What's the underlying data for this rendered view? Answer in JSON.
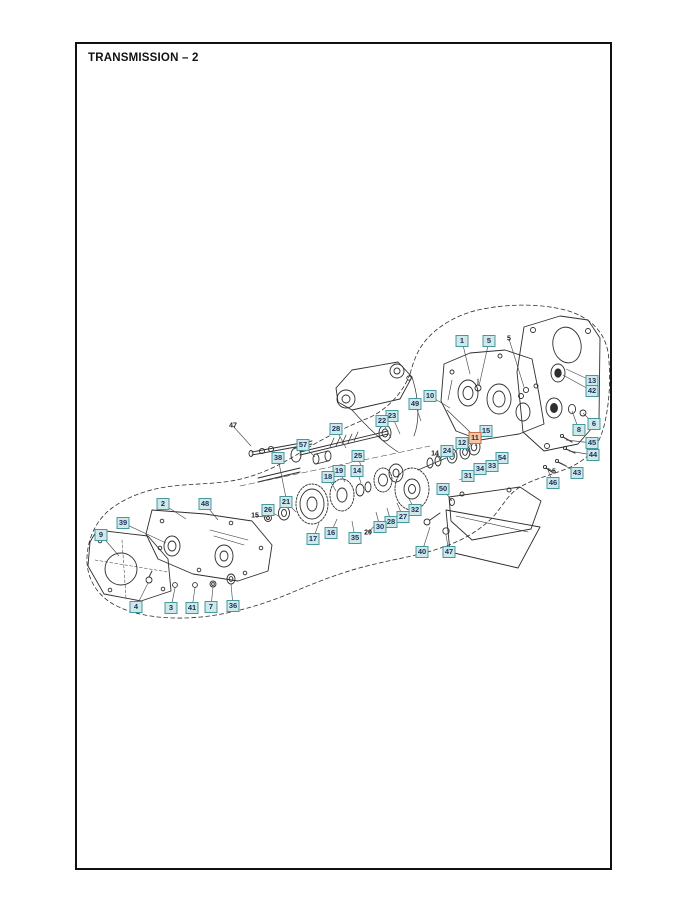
{
  "page": {
    "title": "TRANSMISSION – 2"
  },
  "diagram": {
    "colors": {
      "callout_bg": "#cfe9e9",
      "callout_border": "#44989e",
      "callout_text": "#1c2f5e",
      "highlight_bg": "#f6c6a2",
      "highlight_border": "#c96f4a",
      "leader_line": "#4d4d4d",
      "art_line": "#2e2e2e"
    },
    "callouts": [
      {
        "n": "1",
        "x": 462,
        "y": 341,
        "tx": 470,
        "ty": 374
      },
      {
        "n": "5",
        "x": 489,
        "y": 341,
        "tx": 479,
        "ty": 386
      },
      {
        "n": "13",
        "x": 592,
        "y": 381,
        "tx": 566,
        "ty": 369
      },
      {
        "n": "42",
        "x": 592,
        "y": 391,
        "tx": 563,
        "ty": 375
      },
      {
        "n": "10",
        "x": 430,
        "y": 396,
        "tx": 450,
        "ty": 408
      },
      {
        "n": "49",
        "x": 415,
        "y": 404,
        "tx": 421,
        "ty": 421
      },
      {
        "n": "23",
        "x": 392,
        "y": 416,
        "tx": 400,
        "ty": 434
      },
      {
        "n": "22",
        "x": 382,
        "y": 421,
        "tx": 391,
        "ty": 438
      },
      {
        "n": "6",
        "x": 594,
        "y": 424,
        "tx": 583,
        "ty": 413
      },
      {
        "n": "8",
        "x": 579,
        "y": 430,
        "tx": 572,
        "ty": 411
      },
      {
        "n": "15",
        "x": 486,
        "y": 431,
        "tx": 475,
        "ty": 446
      },
      {
        "n": "11",
        "x": 475,
        "y": 438,
        "tx": 466,
        "ty": 451,
        "hl": true
      },
      {
        "n": "12",
        "x": 462,
        "y": 443,
        "tx": 453,
        "ty": 455
      },
      {
        "n": "45",
        "x": 592,
        "y": 443,
        "tx": 566,
        "ty": 440
      },
      {
        "n": "28",
        "x": 336,
        "y": 429,
        "tx": 346,
        "ty": 448
      },
      {
        "n": "57",
        "x": 303,
        "y": 445,
        "tx": 315,
        "ty": 457
      },
      {
        "n": "24",
        "x": 447,
        "y": 451,
        "tx": 439,
        "ty": 460
      },
      {
        "n": "44",
        "x": 593,
        "y": 455,
        "tx": 569,
        "ty": 451
      },
      {
        "n": "25",
        "x": 358,
        "y": 456,
        "tx": 362,
        "ty": 470
      },
      {
        "n": "38",
        "x": 278,
        "y": 458,
        "tx": 288,
        "ty": 508
      },
      {
        "n": "54",
        "x": 502,
        "y": 458,
        "tx": 490,
        "ty": 465
      },
      {
        "n": "33",
        "x": 492,
        "y": 466,
        "tx": 481,
        "ty": 471
      },
      {
        "n": "34",
        "x": 480,
        "y": 469,
        "tx": 471,
        "ty": 475
      },
      {
        "n": "19",
        "x": 339,
        "y": 471,
        "tx": 345,
        "ty": 482
      },
      {
        "n": "14",
        "x": 357,
        "y": 471,
        "tx": 361,
        "ty": 483
      },
      {
        "n": "43",
        "x": 577,
        "y": 473,
        "tx": 561,
        "ty": 463
      },
      {
        "n": "31",
        "x": 468,
        "y": 476,
        "tx": 459,
        "ty": 480
      },
      {
        "n": "18",
        "x": 328,
        "y": 477,
        "tx": 336,
        "ty": 491
      },
      {
        "n": "46",
        "x": 553,
        "y": 483,
        "tx": 548,
        "ty": 470
      },
      {
        "n": "50",
        "x": 443,
        "y": 489,
        "tx": 452,
        "ty": 501
      },
      {
        "n": "21",
        "x": 286,
        "y": 502,
        "tx": 296,
        "ty": 512
      },
      {
        "n": "2",
        "x": 163,
        "y": 504,
        "tx": 186,
        "ty": 519
      },
      {
        "n": "48",
        "x": 205,
        "y": 504,
        "tx": 218,
        "ty": 520
      },
      {
        "n": "26",
        "x": 268,
        "y": 510,
        "tx": 280,
        "ty": 517
      },
      {
        "n": "32",
        "x": 415,
        "y": 510,
        "tx": 408,
        "ty": 497
      },
      {
        "n": "27",
        "x": 403,
        "y": 517,
        "tx": 397,
        "ty": 503
      },
      {
        "n": "28",
        "x": 391,
        "y": 522,
        "tx": 387,
        "ty": 508
      },
      {
        "n": "39",
        "x": 123,
        "y": 523,
        "tx": 166,
        "ty": 543
      },
      {
        "n": "30",
        "x": 380,
        "y": 527,
        "tx": 376,
        "ty": 512
      },
      {
        "n": "16",
        "x": 331,
        "y": 533,
        "tx": 337,
        "ty": 519
      },
      {
        "n": "9",
        "x": 101,
        "y": 535,
        "tx": 119,
        "ty": 556
      },
      {
        "n": "35",
        "x": 355,
        "y": 538,
        "tx": 352,
        "ty": 521
      },
      {
        "n": "17",
        "x": 313,
        "y": 539,
        "tx": 319,
        "ty": 523
      },
      {
        "n": "40",
        "x": 422,
        "y": 552,
        "tx": 430,
        "ty": 527
      },
      {
        "n": "47",
        "x": 449,
        "y": 552,
        "tx": 446,
        "ty": 535
      },
      {
        "n": "4",
        "x": 136,
        "y": 607,
        "tx": 148,
        "ty": 583
      },
      {
        "n": "3",
        "x": 171,
        "y": 608,
        "tx": 175,
        "ty": 588
      },
      {
        "n": "41",
        "x": 192,
        "y": 608,
        "tx": 195,
        "ty": 588
      },
      {
        "n": "7",
        "x": 211,
        "y": 607,
        "tx": 213,
        "ty": 587
      },
      {
        "n": "36",
        "x": 233,
        "y": 606,
        "tx": 231,
        "ty": 584
      }
    ],
    "plain_refs": [
      {
        "t": "47",
        "x": 233,
        "y": 426,
        "tx": 251,
        "ty": 446
      },
      {
        "t": "5",
        "x": 509,
        "y": 339,
        "tx": 524,
        "ty": 387
      },
      {
        "t": "14",
        "x": 435,
        "y": 454,
        "tx": 440,
        "ty": 459
      },
      {
        "t": "15",
        "x": 255,
        "y": 516,
        "tx": 266,
        "ty": 517
      },
      {
        "t": "29",
        "x": 368,
        "y": 533,
        "tx": 376,
        "ty": 524
      },
      {
        "t": "5",
        "x": 554,
        "y": 472,
        "tx": 548,
        "ty": 468
      }
    ]
  }
}
